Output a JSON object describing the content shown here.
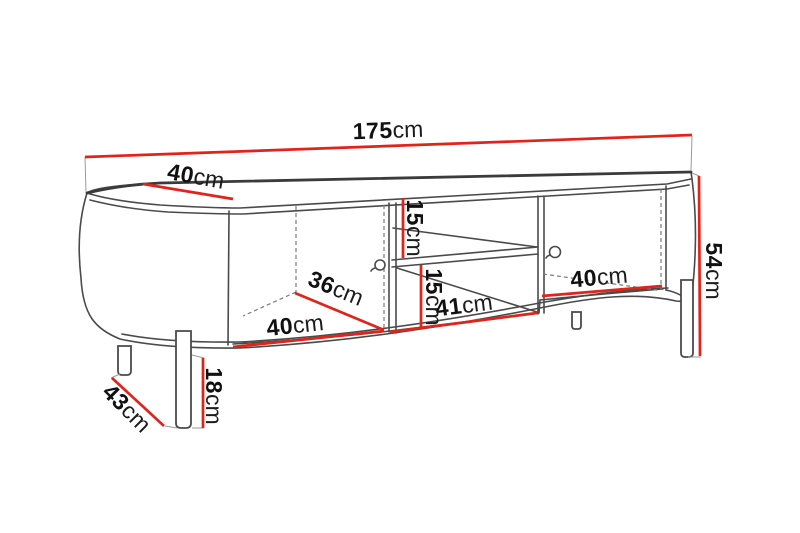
{
  "diagram": {
    "subject": "TV stand dimension drawing: rounded-end cabinet with two doors, open middle compartment with shelf, and metal legs",
    "unit": "cm",
    "colors": {
      "dimension_line": "#e2231a",
      "outline": "#4a4a4a",
      "background": "#ffffff",
      "label_text": "#111111"
    }
  },
  "dims": {
    "total_width": {
      "value": "175",
      "unit": "cm"
    },
    "top_depth": {
      "value": "40",
      "unit": "cm"
    },
    "total_height": {
      "value": "54",
      "unit": "cm"
    },
    "upper_shelf_height": {
      "value": "15",
      "unit": "cm"
    },
    "lower_shelf_height": {
      "value": "15",
      "unit": "cm"
    },
    "left_door_width": {
      "value": "40",
      "unit": "cm"
    },
    "left_interior_depth": {
      "value": "36",
      "unit": "cm"
    },
    "middle_shelf_width": {
      "value": "41",
      "unit": "cm"
    },
    "right_door_width": {
      "value": "40",
      "unit": "cm"
    },
    "leg_height": {
      "value": "18",
      "unit": "cm"
    },
    "base_depth": {
      "value": "43",
      "unit": "cm"
    }
  }
}
